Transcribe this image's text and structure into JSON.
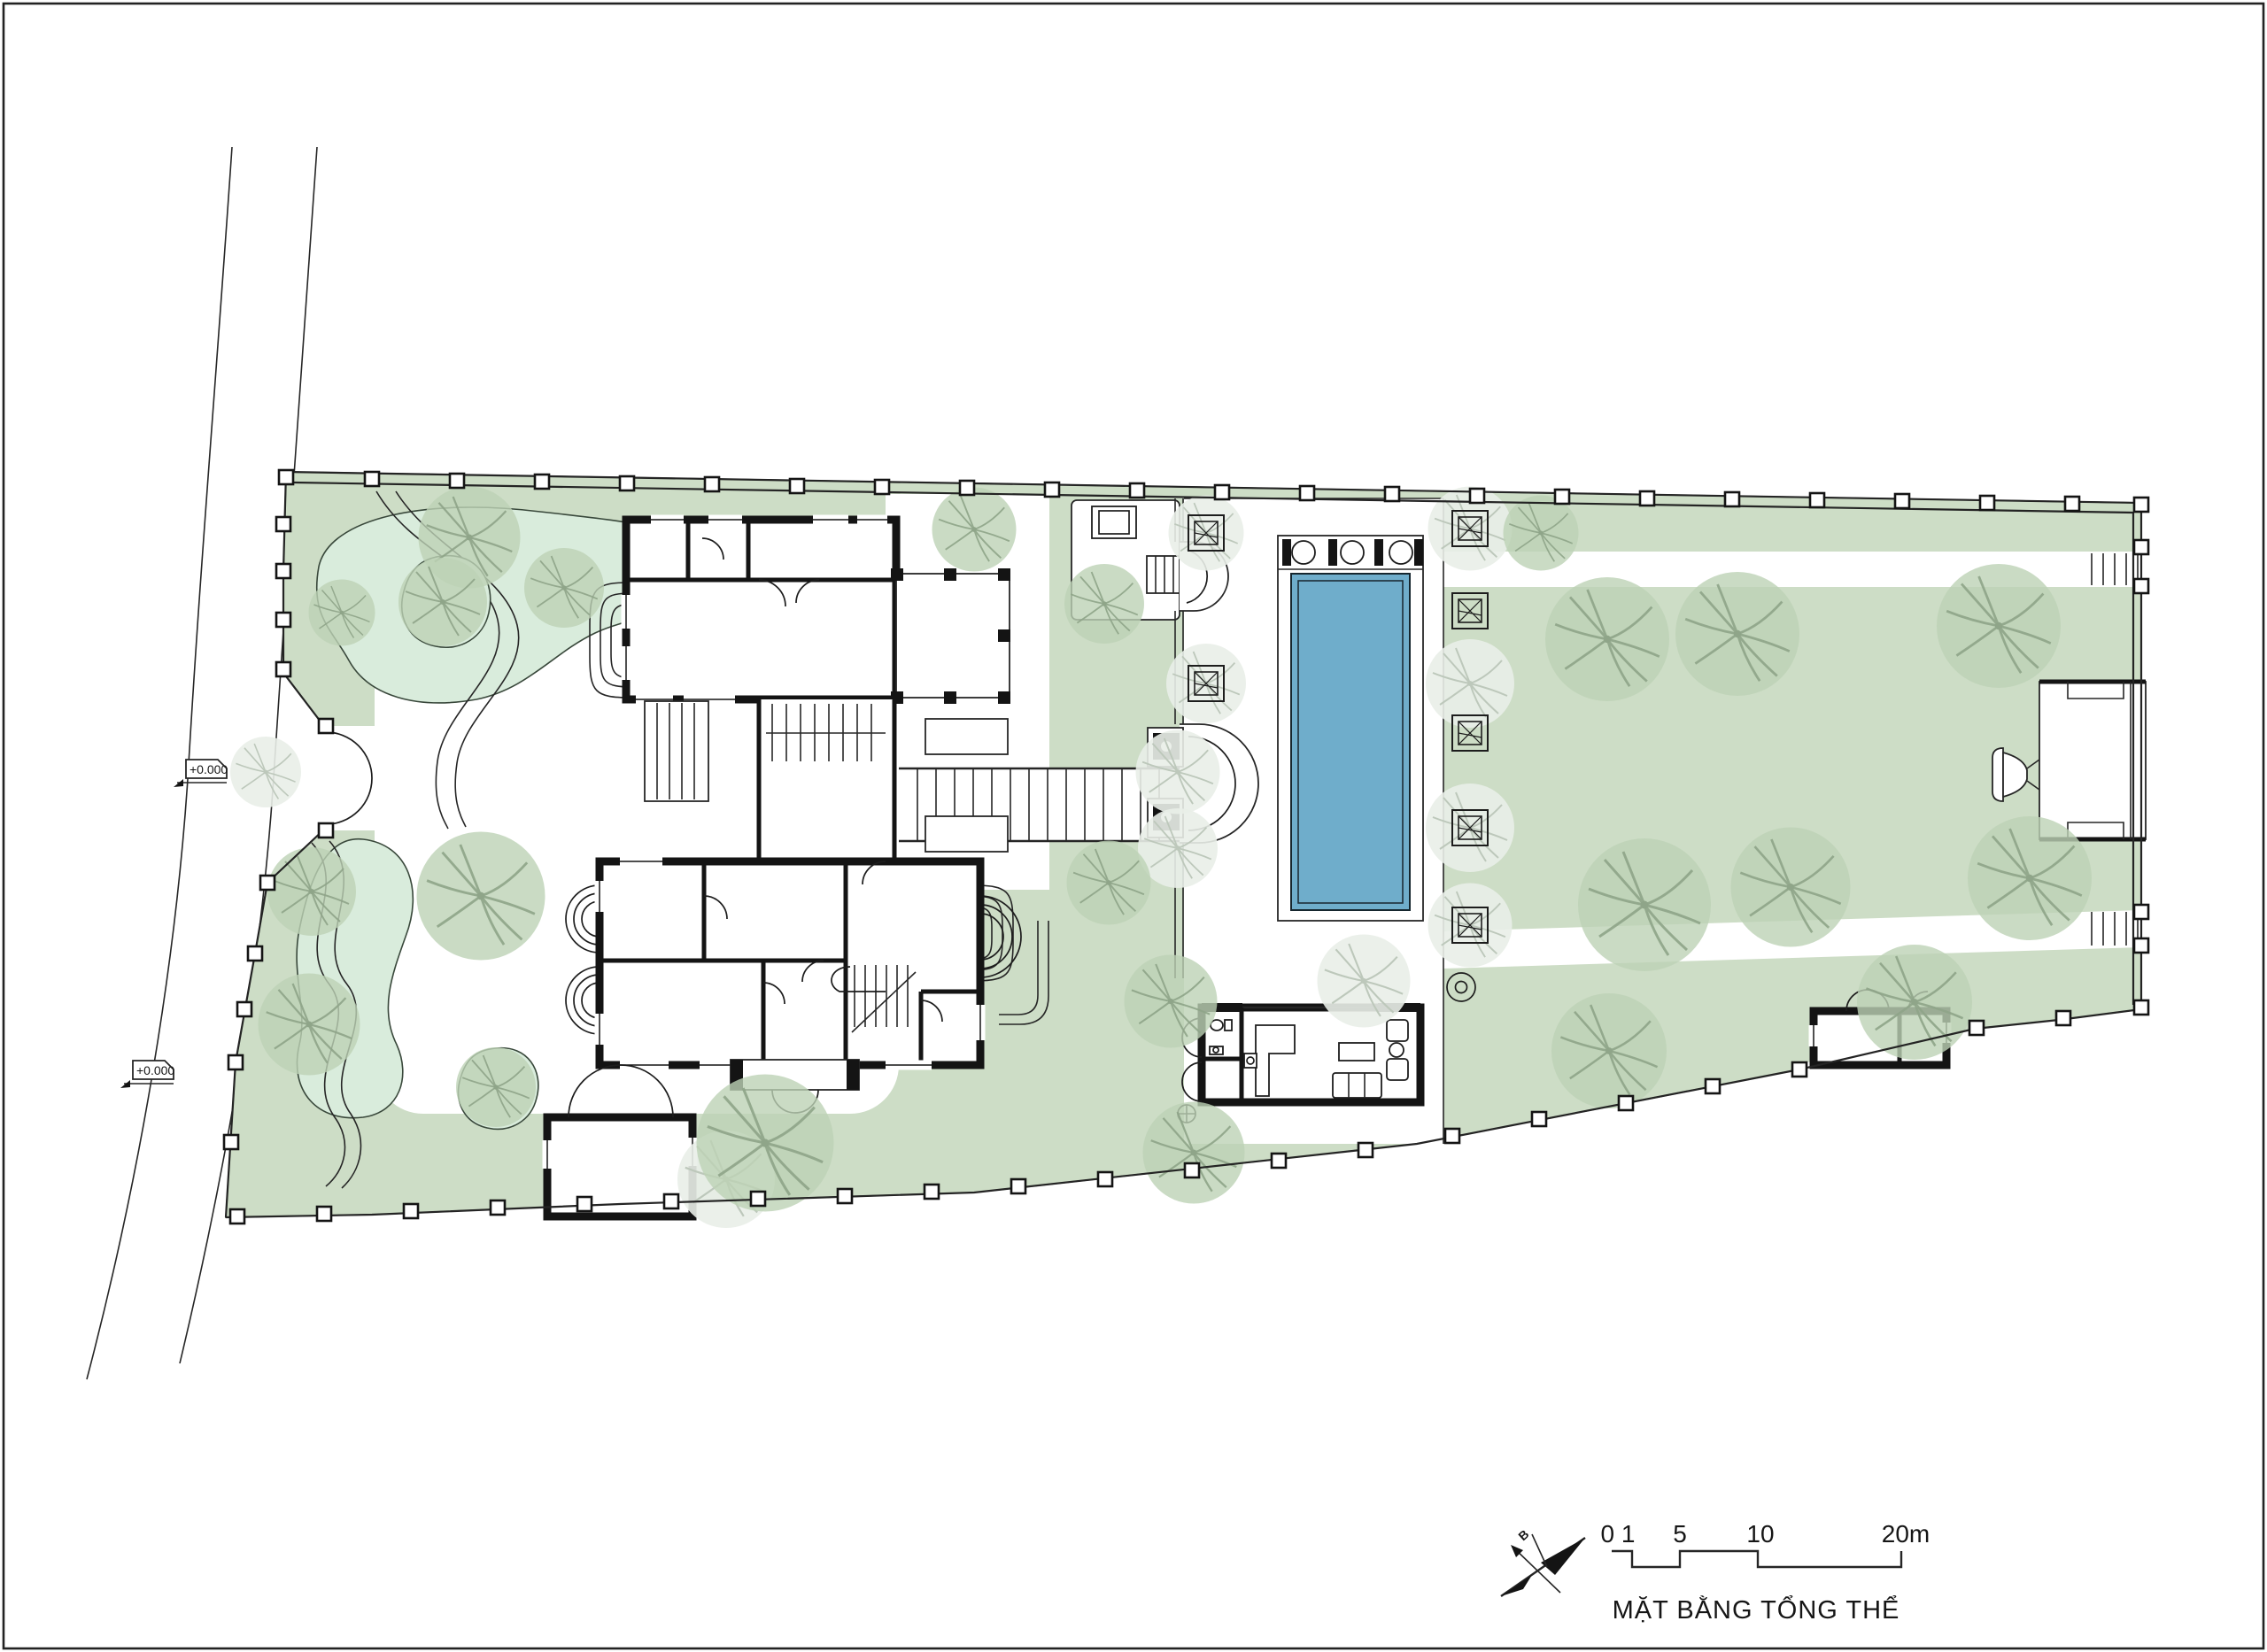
{
  "drawing": {
    "title": "MẶT BẰNG TỔNG THỂ",
    "north_label": "B",
    "scale_bar": {
      "tick_0": "0 1",
      "tick_5": "5",
      "tick_10": "10",
      "tick_20": "20m"
    },
    "elevation_markers": [
      {
        "label": "+0.000"
      },
      {
        "label": "+0.000"
      }
    ]
  },
  "colors": {
    "lawn": "#cdddc6",
    "pond": "#d9ecdc",
    "pool": "#6fadcb",
    "tree-green": "#bdd2b5",
    "tree-branch": "#8fa589",
    "tree-pale": "#e9eee8",
    "tree-pale-branch": "#bdc8bb"
  }
}
